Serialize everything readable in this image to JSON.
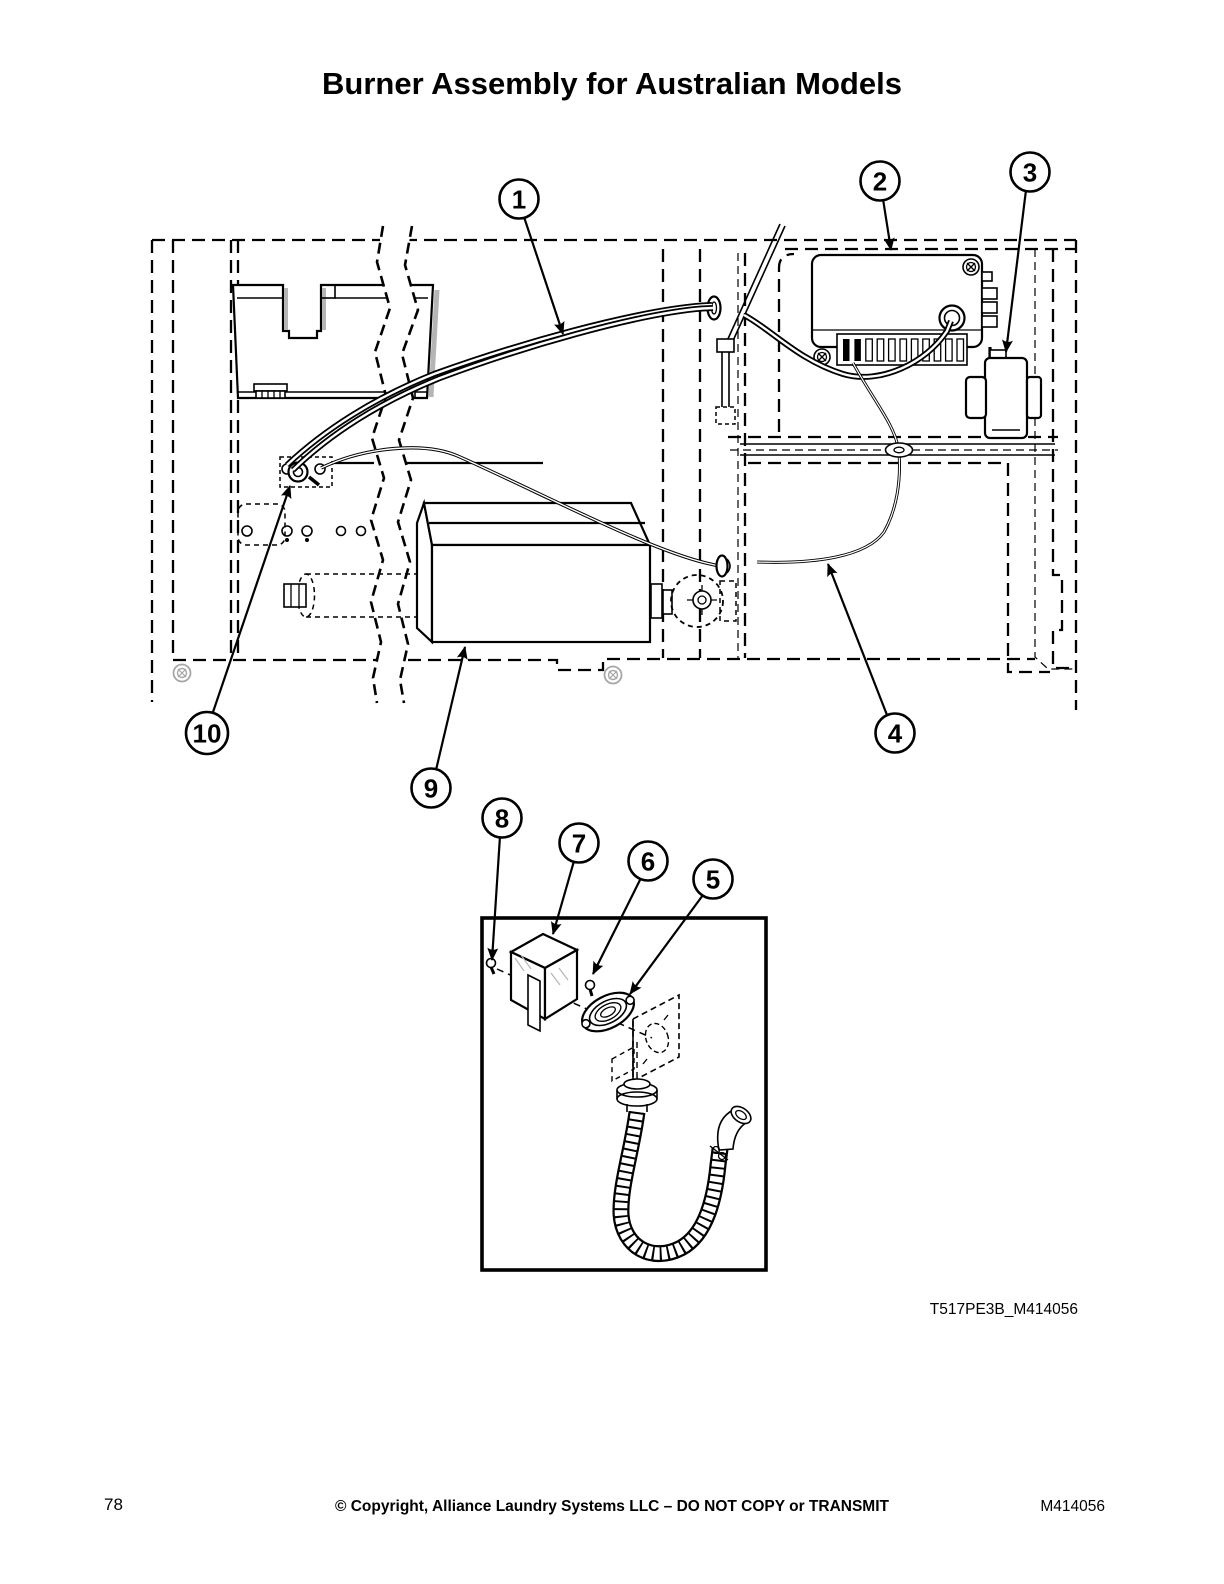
{
  "page": {
    "title": "Burner Assembly for Australian Models",
    "figure_code": "T517PE3B_M414056",
    "footer": {
      "page_number": "78",
      "copyright": "© Copyright, Alliance Laundry Systems LLC – DO NOT COPY or TRANSMIT",
      "doc_number": "M414056"
    }
  },
  "callouts": [
    {
      "label": "1"
    },
    {
      "label": "2"
    },
    {
      "label": "3"
    },
    {
      "label": "4"
    },
    {
      "label": "5"
    },
    {
      "label": "6"
    },
    {
      "label": "7"
    },
    {
      "label": "8"
    },
    {
      "label": "9"
    },
    {
      "label": "10"
    }
  ],
  "colors": {
    "line": "#000000",
    "paper": "#ffffff",
    "shadow": "#b5b5b5"
  }
}
